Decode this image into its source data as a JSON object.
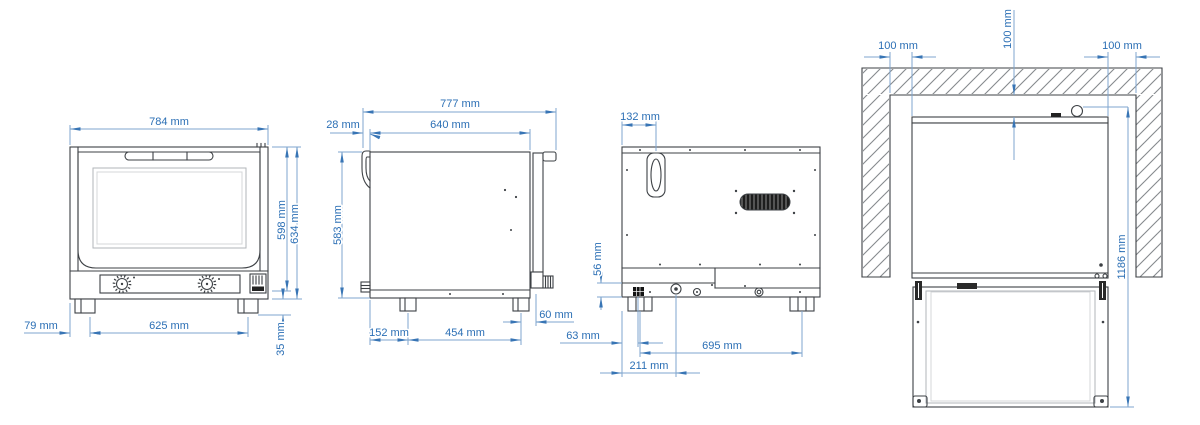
{
  "unit": "mm",
  "colors": {
    "dimension_text": "#2b6fb5",
    "dimension_line": "#7fa6cf",
    "outline": "#3d4145",
    "wall_hatch": "#85898d"
  },
  "views": {
    "front": {
      "dims": {
        "width": "784 mm",
        "body_height": "598 mm",
        "total_height": "634 mm",
        "edge_to_foot": "79 mm",
        "feet_spacing": "625 mm",
        "foot_height": "35 mm"
      }
    },
    "side": {
      "dims": {
        "total_depth": "777 mm",
        "body_depth": "640 mm",
        "flue_protrusion": "28 mm",
        "body_height": "583 mm",
        "back_to_foot": "152 mm",
        "feet_spacing": "454 mm",
        "foot_to_front": "60 mm"
      }
    },
    "back": {
      "dims": {
        "flue_offset": "132 mm",
        "base_panel_height": "56 mm",
        "edge_to_cable_entry": "63 mm",
        "edge_to_connector": "211 mm",
        "feet_spacing": "695 mm"
      }
    },
    "installation": {
      "dims": {
        "clearance_left": "100 mm",
        "clearance_rear": "100 mm",
        "clearance_right": "100 mm",
        "depth_door_open": "1186 mm"
      }
    }
  }
}
